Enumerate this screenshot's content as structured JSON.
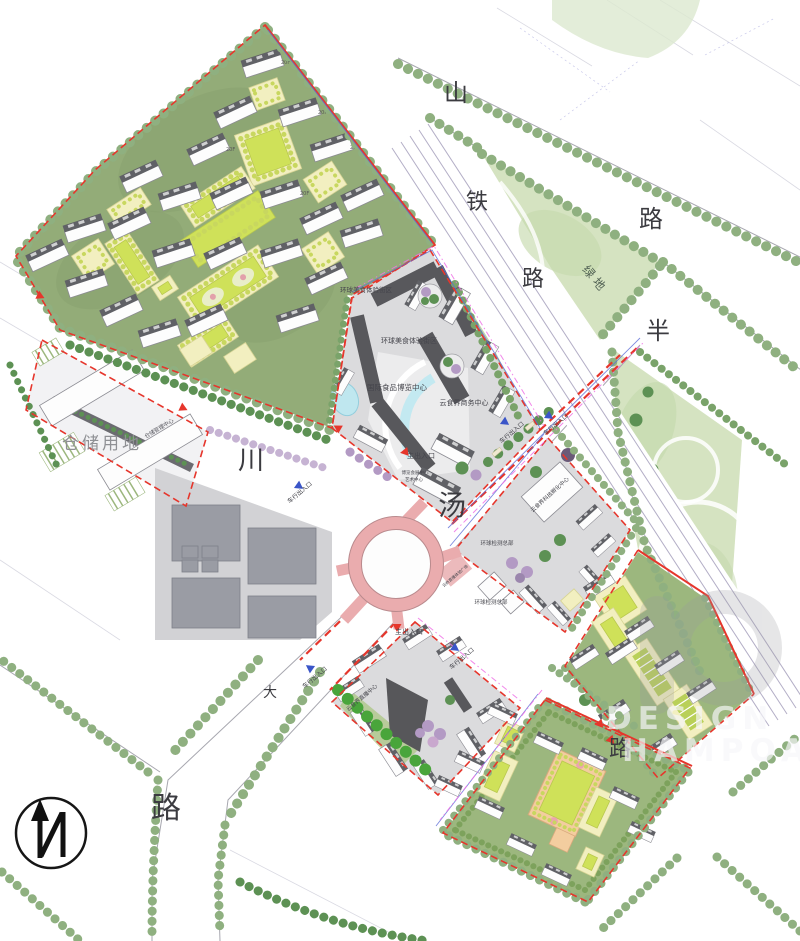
{
  "page": {
    "type": "architectural-master-plan-rendering"
  },
  "road_labels": {
    "shan": "山",
    "lu_top": "路",
    "tie": "铁",
    "lu_rail": "路",
    "lvdi": "绿地",
    "ban": "半",
    "chuan": "川",
    "tang": "汤",
    "da": "大",
    "lu_sw": "路",
    "lu_se": "路"
  },
  "area_labels": {
    "warehouse": "仓储用地",
    "warehouse_center": "仓储管理中心",
    "food_street_1": "环球美食体验街区",
    "food_street_2": "环球美食体验街区",
    "expo_center": "国际食品博览中心",
    "business_center": "云食界商务中心",
    "expo_hall_small": "博览会展中心",
    "art_small": "艺术中心",
    "incubator": "云食界科技孵化中心",
    "testing_hq_1": "环球检测总部",
    "testing_hq_2": "环球检测总部",
    "live_plaza": "云商直播体验广场",
    "live_center": "云食界直播中心"
  },
  "entrances": {
    "main": "主出入口",
    "vehicle": "车行出入口"
  },
  "floor_tags": [
    "20F",
    "20F",
    "20F",
    "20F",
    "20F"
  ],
  "watermark": {
    "line1": "DESIGN",
    "line2": "HAMPOA"
  },
  "compass": {
    "letter": "N"
  },
  "colors": {
    "boundary_red": "#e6362c",
    "water_cyan": "#bfe7ef",
    "roundabout_pink": "#eaacae",
    "railway_line": "#b3aec6",
    "lawn_green": "#93ac78",
    "paving_gray": "#dbdbdd",
    "roof_dark": "#606166",
    "commercial_dark": "#58585c",
    "tree_green": "#8fb080",
    "tree_purple": "#b39ac4",
    "magenta_line": "#ee72e6",
    "blue_line": "#5b6bd6"
  }
}
